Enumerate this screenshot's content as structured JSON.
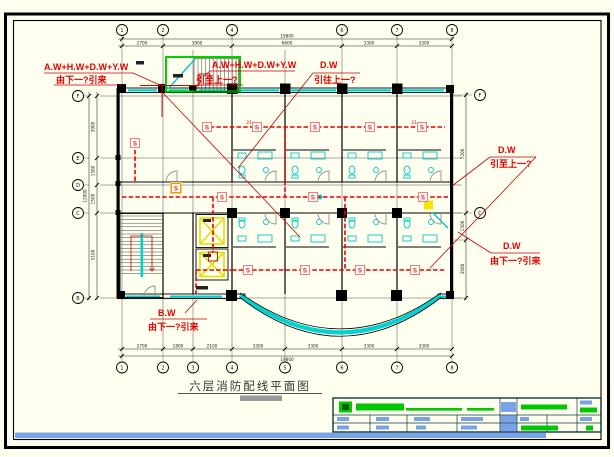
{
  "sheet": {
    "background": "#FFFFF0",
    "frame_color": "#000000"
  },
  "palette": {
    "annotation_red": "#E60000",
    "wiring_red": "#E60000",
    "cyan": "#00D2D2",
    "green": "#00C800",
    "elevator_yellow": "#E0E000",
    "detector_pink": "#F08080",
    "titleblock_blue": "#7AA3E6",
    "titleblock_border": "#0B3B3B",
    "wall_black": "#000000",
    "door_gray": "#909090"
  },
  "annotations": {
    "left_top": {
      "line1": "A.W+H.W+D.W+Y.W",
      "line2": "由下一?引来"
    },
    "mid_top": {
      "line1": "A.W+H.W+D.W+Y.W",
      "line2": "引至上一?"
    },
    "dw_mid": {
      "line1": "D.W",
      "line2": "引往上一?"
    },
    "dw_right_top": {
      "line1": "D.W",
      "line2": "引至上一?"
    },
    "dw_right_bottom": {
      "line1": "D.W",
      "line2": "由下一?引来"
    },
    "bw_bottom": {
      "line1": "B.W",
      "line2": "由下一?引来"
    }
  },
  "plan_title": {
    "text": "六层消防配线平面图"
  },
  "detector": {
    "label": "S",
    "count_labels": [
      "21",
      "21"
    ]
  },
  "grid": {
    "top_bubbles": [
      "1",
      "2",
      "4",
      "6",
      "7",
      "8"
    ],
    "bottom_bubbles": [
      "1",
      "2",
      "3",
      "4",
      "5",
      "6",
      "7",
      "8"
    ],
    "left_bubbles": [
      "F",
      "E",
      "D",
      "C",
      "B"
    ],
    "right_bubbles": [
      "F",
      "C"
    ]
  },
  "dimensions": {
    "top": [
      "2700",
      "3900",
      "6600",
      "3300",
      "3300"
    ],
    "top_overall": "19800",
    "bottom": [
      "2700",
      "1800",
      "2100",
      "3300",
      "3300",
      "3300",
      "3300"
    ],
    "bottom_overall": "19800",
    "left": [
      "3900",
      "1500",
      "1500",
      "5100"
    ],
    "left_overall": "12000",
    "right": [
      "7200",
      "1500",
      "3600"
    ]
  }
}
